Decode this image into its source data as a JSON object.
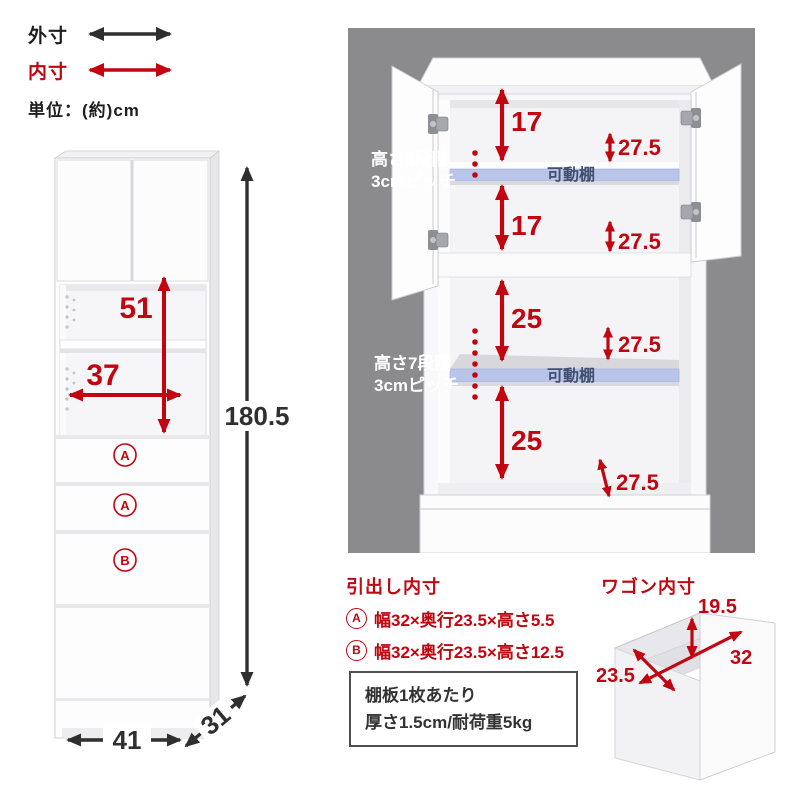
{
  "legend": {
    "outer_label": "外寸",
    "inner_label": "内寸",
    "unit_label": "単位：(約)cm"
  },
  "colors": {
    "red": "#c10511",
    "arrow_black": "#2f2f2f",
    "panel_gray": "#8b8b8d",
    "shelf_blue": "#b9c5e8"
  },
  "front_view": {
    "inner_height": "51",
    "inner_width": "37",
    "total_height": "180.5",
    "outer_width": "41",
    "outer_depth": "31",
    "drawer1_label": "A",
    "drawer2_label": "A",
    "drawer3_label": "B"
  },
  "open_view": {
    "upper_note_line1": "高さ3段階",
    "upper_note_line2": "3cmピッチ",
    "lower_note_line1": "高さ7段階",
    "lower_note_line2": "3cmピッチ",
    "upper_seg1": "17",
    "upper_seg2": "17",
    "upper_depth1": "27.5",
    "upper_depth2": "27.5",
    "lower_seg1": "25",
    "lower_seg2": "25",
    "lower_depth1": "27.5",
    "lower_depth2": "27.5",
    "shelf_label_upper": "可動棚",
    "shelf_label_lower": "可動棚"
  },
  "drawer_specs": {
    "title": "引出し内寸",
    "row_a_badge": "A",
    "row_a_text": "幅32×奥行23.5×高さ5.5",
    "row_b_badge": "B",
    "row_b_text": "幅32×奥行23.5×高さ12.5"
  },
  "shelf_note": {
    "line1": "棚板1枚あたり",
    "line2": "厚さ1.5cm/耐荷重5kg"
  },
  "wagon": {
    "title": "ワゴン内寸",
    "inner_height": "19.5",
    "inner_width": "32",
    "inner_depth": "23.5"
  }
}
